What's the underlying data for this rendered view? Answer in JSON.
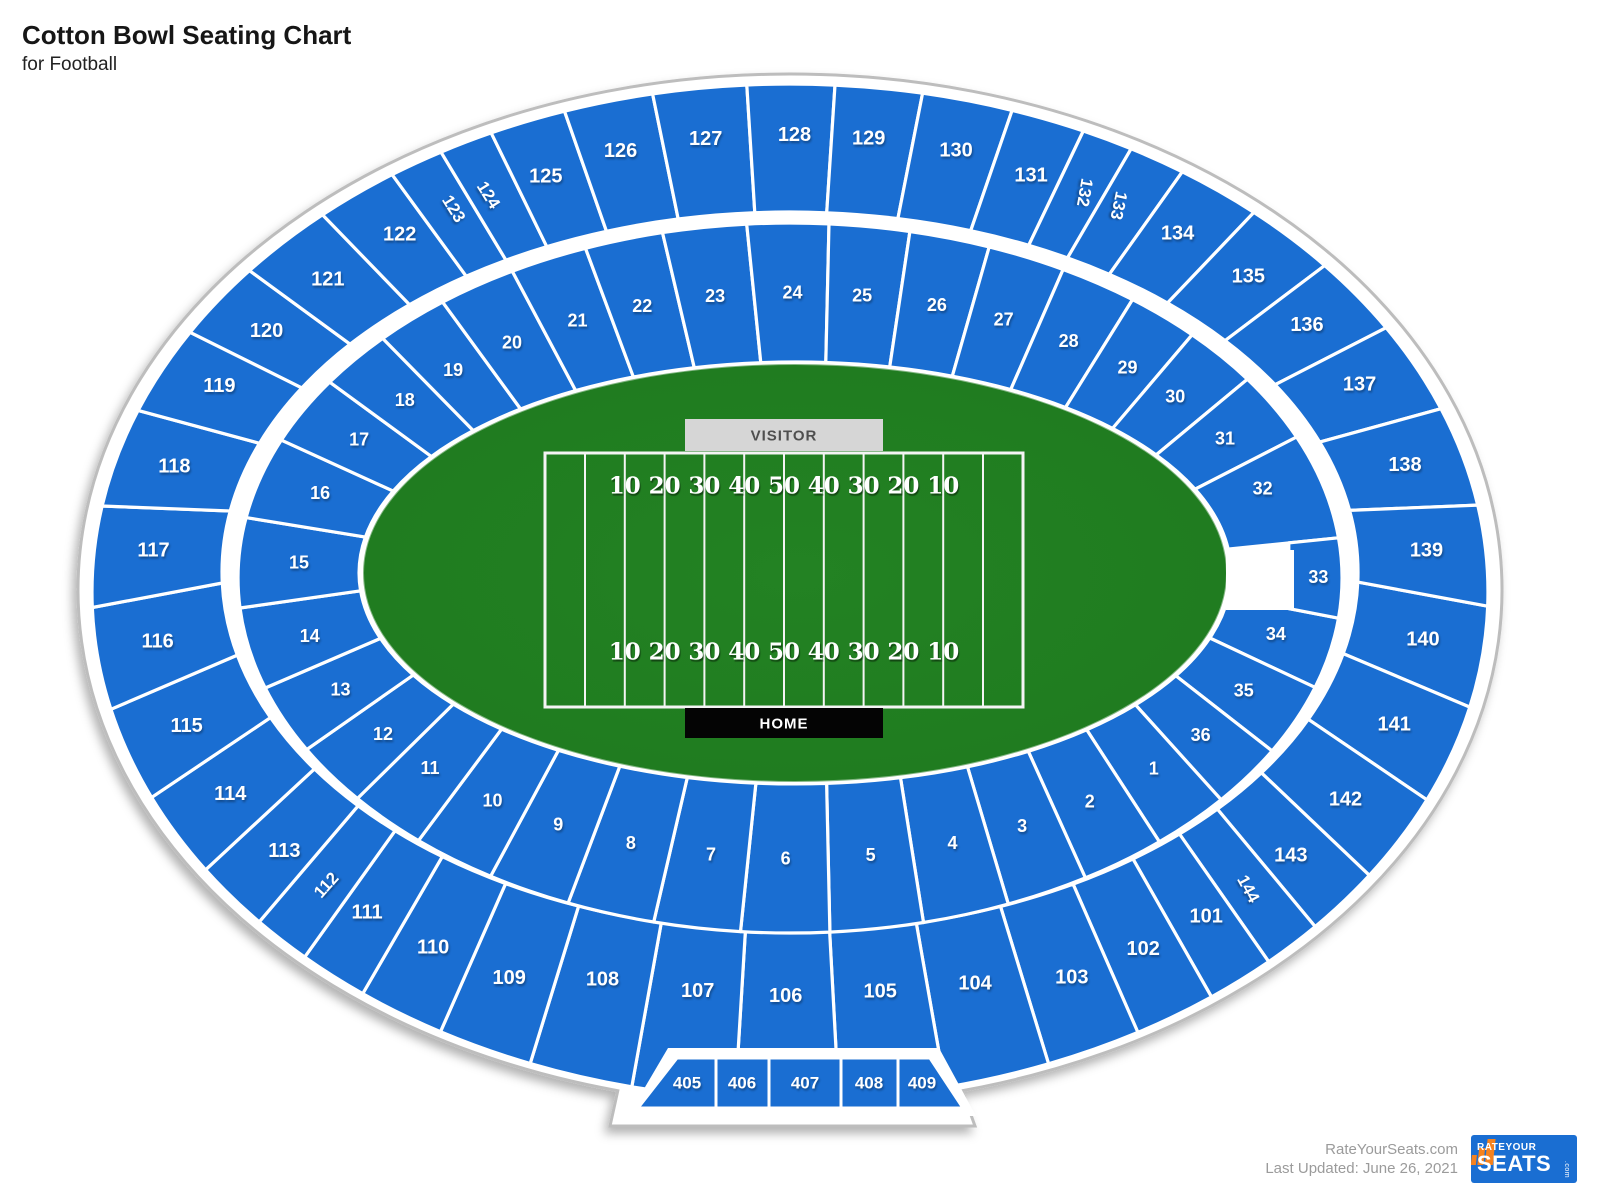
{
  "title": "Cotton Bowl Seating Chart",
  "subtitle": "for Football",
  "field": {
    "visitor_label": "VISITOR",
    "home_label": "HOME",
    "yard_numbers": [
      "10",
      "20",
      "30",
      "40",
      "50",
      "40",
      "30",
      "20",
      "10"
    ]
  },
  "sections": {
    "inner": [
      "1",
      "2",
      "3",
      "4",
      "5",
      "6",
      "7",
      "8",
      "9",
      "10",
      "11",
      "12",
      "13",
      "14",
      "15",
      "16",
      "17",
      "18",
      "19",
      "20",
      "21",
      "22",
      "23",
      "24",
      "25",
      "26",
      "27",
      "28",
      "29",
      "30",
      "31",
      "32",
      "33",
      "34",
      "35",
      "36"
    ],
    "outer": [
      "101",
      "102",
      "103",
      "104",
      "105",
      "106",
      "107",
      "108",
      "109",
      "110",
      "111",
      "112",
      "113",
      "114",
      "115",
      "116",
      "117",
      "118",
      "119",
      "120",
      "121",
      "122",
      "123",
      "124",
      "125",
      "126",
      "127",
      "128",
      "129",
      "130",
      "131",
      "132",
      "133",
      "134",
      "135",
      "136",
      "137",
      "138",
      "139",
      "140",
      "141",
      "142",
      "143",
      "144"
    ],
    "boxes": [
      "405",
      "406",
      "407",
      "408",
      "409"
    ]
  },
  "footer": {
    "source": "RateYourSeats.com",
    "updated": "Last Updated: June 26, 2021"
  },
  "logo": {
    "rate_your": "RATEYOUR",
    "seats": "SEATS",
    "com": ".com"
  },
  "colors": {
    "section_blue": "#1a6ed2",
    "field_green": "#1f7b1f",
    "field_green_edge": "#1b701b",
    "visitor_bg": "#d6d6d6",
    "visitor_text": "#4f4f4f",
    "home_bg": "#040404",
    "home_text": "#ffffff",
    "outline_gray": "#bdbdbd",
    "logo_orange": "#f5821f"
  }
}
